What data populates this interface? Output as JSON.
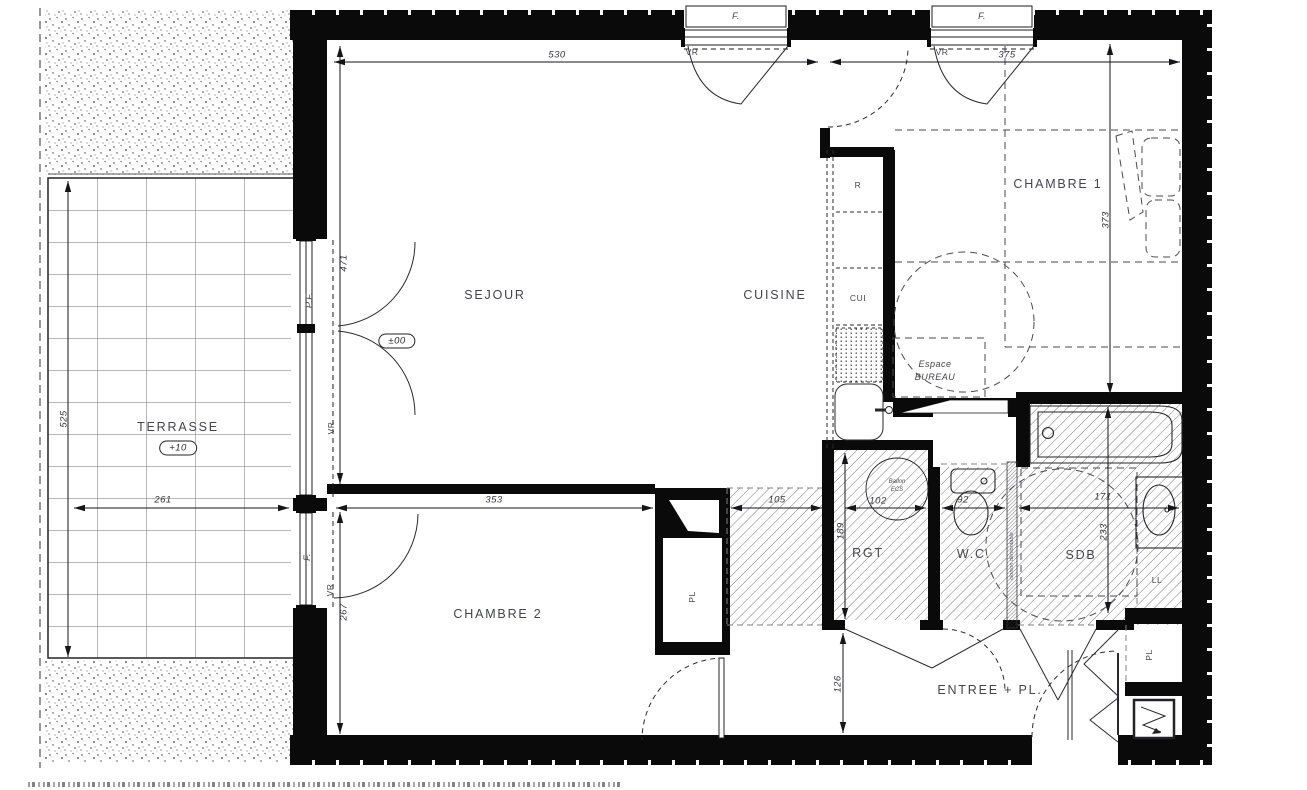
{
  "rooms": {
    "sejour": "SEJOUR",
    "cuisine": "CUISINE",
    "chambre1": "CHAMBRE 1",
    "chambre2": "CHAMBRE 2",
    "terrasse": "TERRASSE",
    "rgt": "RGT",
    "wc": "W.C.",
    "sdb": "SDB",
    "entree": "ENTREE + PL.",
    "espace_bureau_line1": "Espace",
    "espace_bureau_line2": "BUREAU"
  },
  "levels": {
    "interior": "±00",
    "terrasse": "+10"
  },
  "fixtures": {
    "fridge": "R",
    "cooktop": "CUI",
    "washing_machine": "LL",
    "closet_chambre2": "PL",
    "closet_entree": "PL",
    "water_heater_line1": "Ballon",
    "water_heater_line2": "ECS",
    "removable_partition": "cloison démontable"
  },
  "openings": {
    "window_top_left": "F.",
    "window_top_right": "F.",
    "french_door_sejour": "P.F.",
    "window_chambre2": "F.",
    "shutter_top_left": "VR",
    "shutter_top_right": "VR",
    "shutter_sejour": "VR",
    "shutter_chambre2": "VR"
  },
  "dimensions": {
    "sejour_width": "530",
    "chambre1_width": "375",
    "chambre1_depth": "373",
    "sejour_depth": "471",
    "terrasse_depth": "525",
    "terrasse_width": "261",
    "chambre2_width": "353",
    "chambre2_depth": "267",
    "hall_width": "105",
    "rgt_depth": "189",
    "rgt_width": "102",
    "wc_width": "92",
    "sdb_width": "171",
    "sdb_depth": "233",
    "entree_depth": "126"
  }
}
